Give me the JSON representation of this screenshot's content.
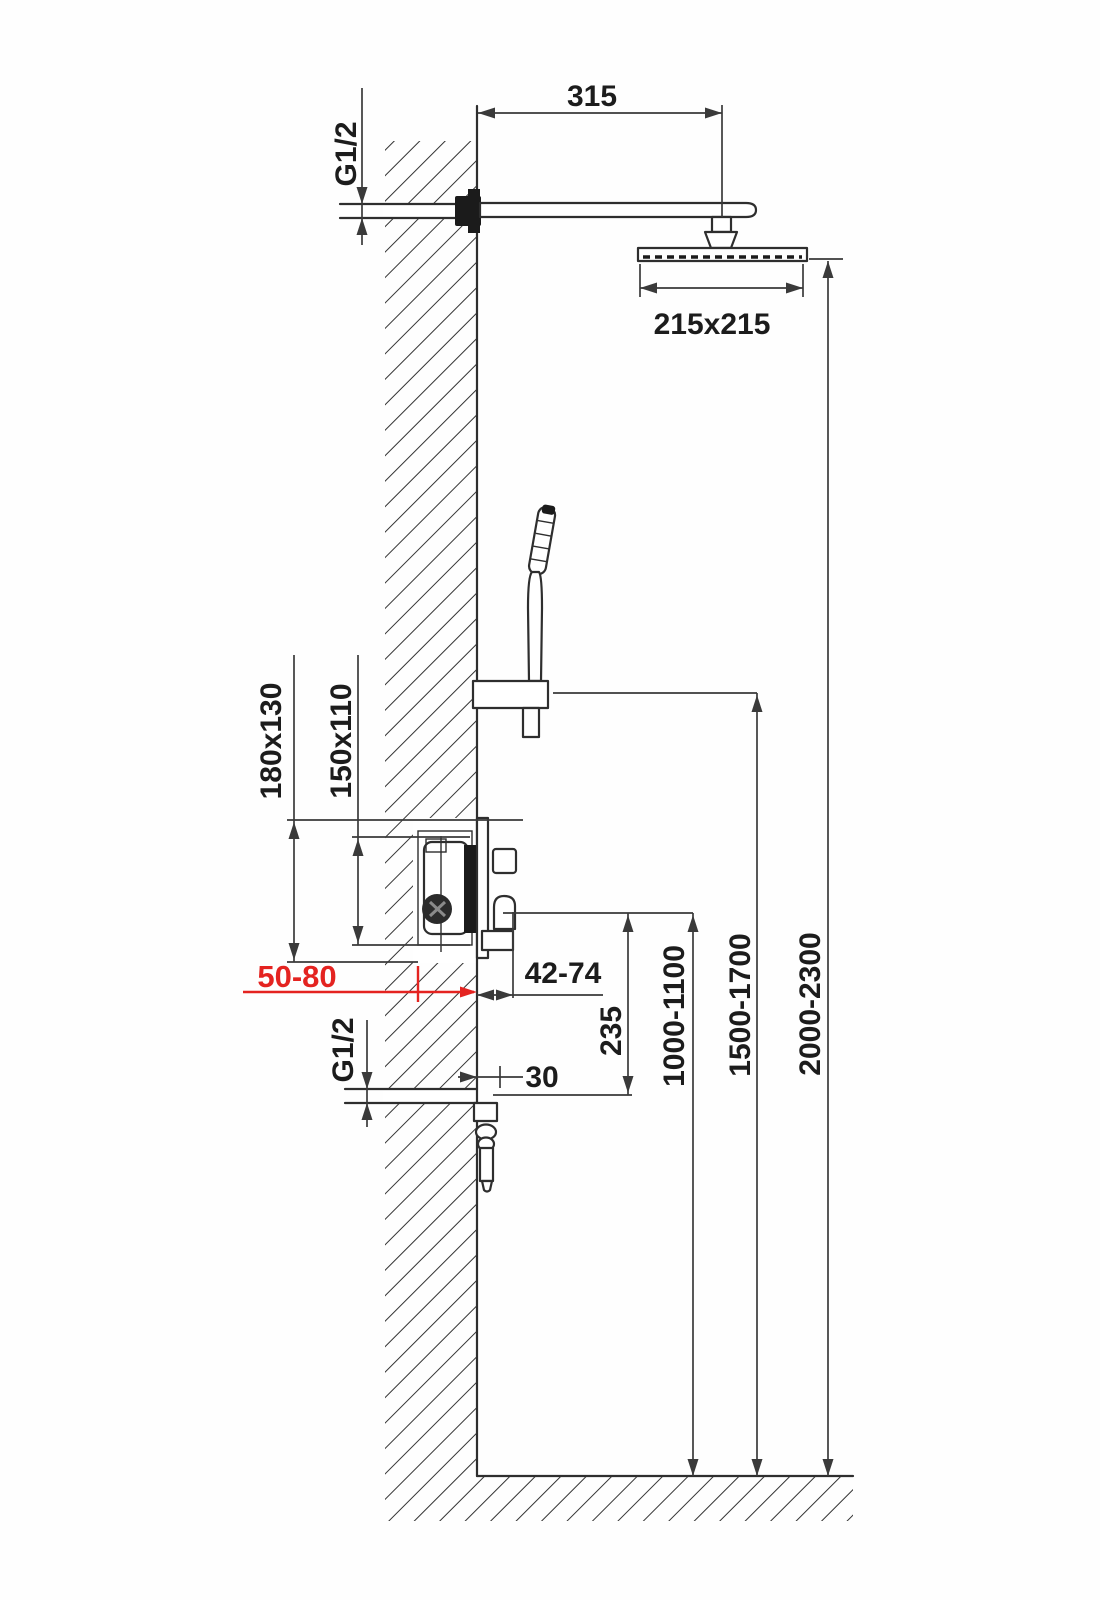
{
  "diagram": {
    "title": "shower-system-installation-dimensions",
    "colors": {
      "line": "#2e2e2e",
      "dim": "#3a3a3a",
      "highlight": "#e42320",
      "dark": "#1b1b1b"
    },
    "labels": {
      "arm_reach": "315",
      "head_size": "215x215",
      "thread_top": "G1/2",
      "thread_bottom": "G1/2",
      "rough_opening": "180x130",
      "concealed_box": "150x110",
      "embed_depth": "50-80",
      "lever_clearance": "42-74",
      "spout_projection": "30",
      "outlet_offset": "235",
      "mixer_height": "1000-1100",
      "handshower_height": "1500-1700",
      "showerhead_height": "2000-2300"
    }
  }
}
